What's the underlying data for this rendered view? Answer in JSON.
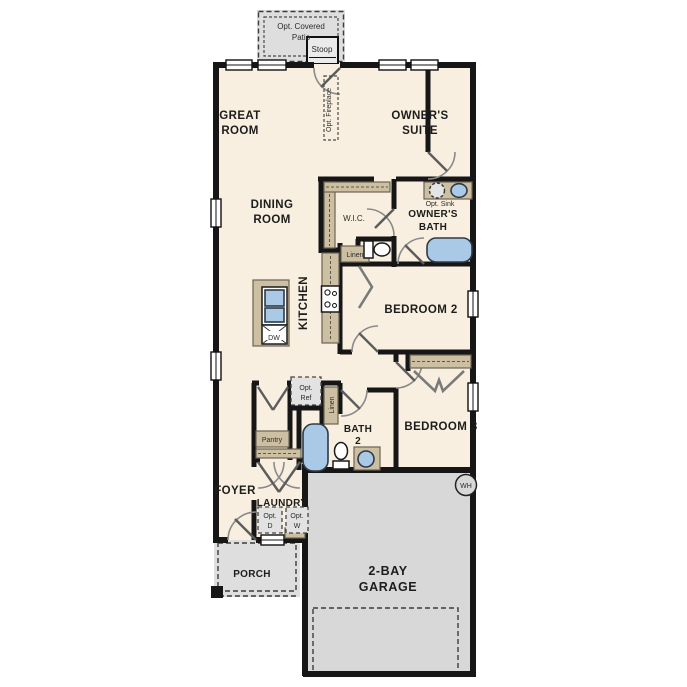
{
  "plan": {
    "type": "single-story floor plan",
    "colors": {
      "floor": "#f8efe0",
      "walls": "#161616",
      "garage_slab": "#d8d8d8",
      "porch_patio_slab": "#dedede",
      "cabinet_tan": "#cdbfa2",
      "fixture_blue": "#aac9e6",
      "label_text": "#1d1d1d"
    }
  },
  "labels": {
    "opt_covered_patio": [
      "Opt. Covered",
      "Patio"
    ],
    "stoop": [
      "Stoop"
    ],
    "great_room": [
      "GREAT",
      "ROOM"
    ],
    "opt_fireplace": [
      "Opt. Fireplace"
    ],
    "owners_suite": [
      "OWNER'S",
      "SUITE"
    ],
    "dining_room": [
      "DINING",
      "ROOM"
    ],
    "wic": [
      "W.I.C."
    ],
    "opt_sink": [
      "Opt. Sink"
    ],
    "owners_bath": [
      "OWNER'S",
      "BATH"
    ],
    "linen_wic": [
      "Linen"
    ],
    "kitchen": [
      "KITCHEN"
    ],
    "dishwasher": [
      "DW"
    ],
    "bedroom2": [
      "BEDROOM 2"
    ],
    "opt_ref": [
      "Opt.",
      "Ref"
    ],
    "linen_hall": [
      "Linen"
    ],
    "pantry": [
      "Pantry"
    ],
    "bath2": [
      "BATH",
      "2"
    ],
    "bedroom3": [
      "BEDROOM 3"
    ],
    "foyer": [
      "FOYER"
    ],
    "laundry": [
      "LAUNDRY"
    ],
    "opt_dryer": [
      "Opt.",
      "D"
    ],
    "opt_washer": [
      "Opt.",
      "W"
    ],
    "porch": [
      "PORCH"
    ],
    "garage": [
      "2-BAY",
      "GARAGE"
    ],
    "water_heater": [
      "WH"
    ]
  },
  "fixtures": [
    "range-stove",
    "kitchen-island-sink",
    "dishwasher",
    "owners-bath-vanity",
    "owners-bath-optional-sink",
    "owners-bath-sink",
    "owners-bath-toilet",
    "owners-bath-tub",
    "bath2-tub",
    "bath2-toilet",
    "bath2-vanity-sink",
    "water-heater",
    "washer-optional",
    "dryer-optional",
    "refrigerator-optional"
  ]
}
